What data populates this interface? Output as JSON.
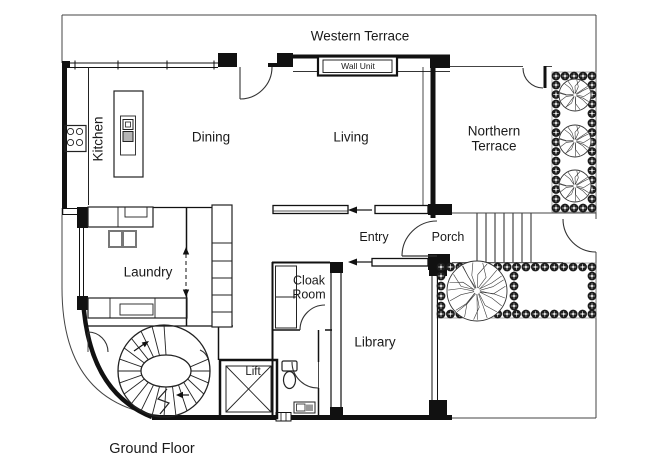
{
  "plan": {
    "floor_name": "Ground Floor",
    "rooms": {
      "kitchen": "Kitchen",
      "dining": "Dining",
      "living": "Living",
      "laundry": "Laundry",
      "entry": "Entry",
      "porch": "Porch",
      "cloak_room": "Cloak Room",
      "library": "Library",
      "lift": "Lift"
    },
    "outdoor_areas": {
      "western_terrace": "Western Terrace",
      "northern_terrace": "Northern Terrace"
    },
    "fixtures": {
      "wall_unit": "Wall Unit"
    },
    "vegetation": {
      "small_trees": 3,
      "large_trees": 1
    },
    "colors": {
      "line": "#111111",
      "background": "#ffffff",
      "hedge": "#1c1c1c"
    }
  }
}
